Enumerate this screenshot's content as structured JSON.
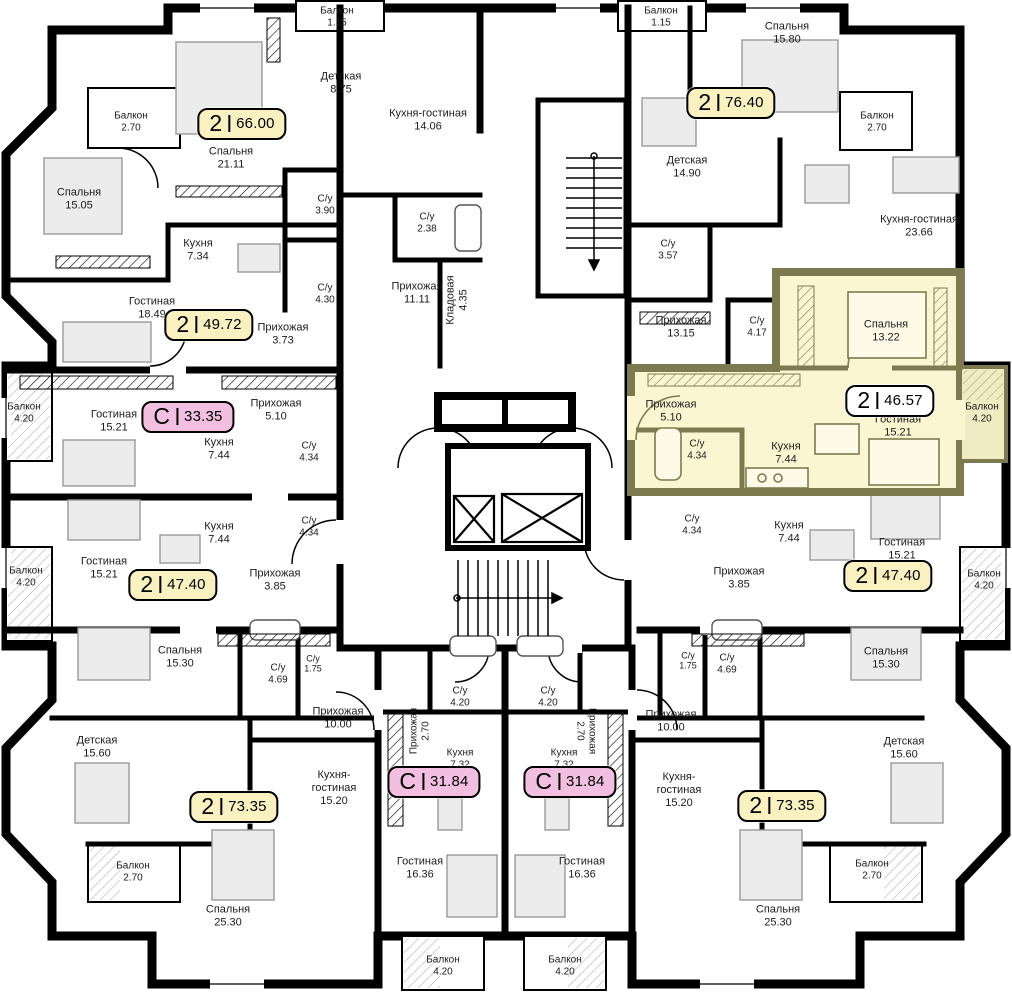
{
  "plan_name": "floor-plan",
  "colors": {
    "wall": "#000000",
    "paper": "#ffffff",
    "badge_yellow": "#f9f2c0",
    "badge_pink": "#f2bfe0",
    "badge_white": "#ffffff",
    "highlight_fill": "#faf6d2",
    "highlight_wall": "#7e7a50",
    "highlight_balcony": "#efebc2",
    "furniture_fill": "#ececec",
    "furniture_stroke": "#999999"
  },
  "icons": {
    "elevator": "elevator-shaft-icon (crossed box)",
    "stairs": "staircase-icon (treads with direction arrow)"
  },
  "apartments": [
    {
      "s": "2",
      "a": "66.00",
      "x": 242,
      "y": 124,
      "c": "yellow"
    },
    {
      "s": "2",
      "a": "76.40",
      "x": 731,
      "y": 103,
      "c": "yellow"
    },
    {
      "s": "2",
      "a": "49.72",
      "x": 209,
      "y": 325,
      "c": "yellow"
    },
    {
      "s": "С",
      "a": "33.35",
      "x": 188,
      "y": 417,
      "c": "pink"
    },
    {
      "s": "2",
      "a": "46.57",
      "x": 890,
      "y": 401,
      "c": "white"
    },
    {
      "s": "2",
      "a": "47.40",
      "x": 173,
      "y": 585,
      "c": "yellow"
    },
    {
      "s": "2",
      "a": "47.40",
      "x": 888,
      "y": 576,
      "c": "yellow"
    },
    {
      "s": "2",
      "a": "73.35",
      "x": 234,
      "y": 807,
      "c": "yellow"
    },
    {
      "s": "С",
      "a": "31.84",
      "x": 434,
      "y": 782,
      "c": "pink"
    },
    {
      "s": "С",
      "a": "31.84",
      "x": 570,
      "y": 782,
      "c": "pink"
    },
    {
      "s": "2",
      "a": "73.35",
      "x": 782,
      "y": 806,
      "c": "yellow"
    }
  ],
  "rooms": [
    {
      "n": "Балкон",
      "a": "1.15",
      "x": 337,
      "y": 17,
      "fs": 10
    },
    {
      "n": "Балкон",
      "a": "1.15",
      "x": 661,
      "y": 17,
      "fs": 10
    },
    {
      "n": "Спальня",
      "a": "15.80",
      "x": 787,
      "y": 33
    },
    {
      "n": "Детская",
      "a": "8.75",
      "x": 341,
      "y": 83
    },
    {
      "n": "Балкон",
      "a": "2.70",
      "x": 131,
      "y": 122,
      "fs": 10
    },
    {
      "n": "Балкон",
      "a": "2.70",
      "x": 877,
      "y": 122,
      "fs": 10
    },
    {
      "n": "Кухня-гостиная",
      "a": "14.06",
      "x": 428,
      "y": 120,
      "w": 80
    },
    {
      "n": "Спальня",
      "a": "21.11",
      "x": 231,
      "y": 158
    },
    {
      "n": "Детская",
      "a": "14.90",
      "x": 687,
      "y": 167
    },
    {
      "n": "Спальня",
      "a": "15.05",
      "x": 79,
      "y": 199
    },
    {
      "n": "С/у",
      "a": "3.90",
      "x": 325,
      "y": 205,
      "fs": 10
    },
    {
      "n": "С/у",
      "a": "2.38",
      "x": 427,
      "y": 223,
      "fs": 10
    },
    {
      "n": "Кухня-гостиная",
      "a": "23.66",
      "x": 919,
      "y": 226,
      "w": 130
    },
    {
      "n": "Кухня",
      "a": "7.34",
      "x": 198,
      "y": 250
    },
    {
      "n": "С/у",
      "a": "3.57",
      "x": 668,
      "y": 250,
      "fs": 10
    },
    {
      "n": "С/у",
      "a": "4.30",
      "x": 325,
      "y": 294,
      "fs": 10
    },
    {
      "n": "Прихожая",
      "a": "11.11",
      "x": 417,
      "y": 293
    },
    {
      "n": "Кладовая",
      "a": "4.35",
      "x": 457,
      "y": 300,
      "r": -90
    },
    {
      "n": "Гостиная",
      "a": "18.49",
      "x": 152,
      "y": 308
    },
    {
      "n": "Прихожая",
      "a": "13.15",
      "x": 681,
      "y": 327
    },
    {
      "n": "С/у",
      "a": "4.17",
      "x": 757,
      "y": 327,
      "fs": 10
    },
    {
      "n": "Прихожая",
      "a": "3.73",
      "x": 283,
      "y": 334
    },
    {
      "n": "Спальня",
      "a": "13.22",
      "x": 886,
      "y": 331
    },
    {
      "n": "Балкон",
      "a": "4.20",
      "x": 24,
      "y": 413,
      "fs": 10,
      "w": 44
    },
    {
      "n": "Гостиная",
      "a": "15.21",
      "x": 114,
      "y": 421
    },
    {
      "n": "Прихожая",
      "a": "5.10",
      "x": 276,
      "y": 410
    },
    {
      "n": "Прихожая",
      "a": "5.10",
      "x": 671,
      "y": 411
    },
    {
      "n": "Гостиная",
      "a": "15.21",
      "x": 898,
      "y": 426
    },
    {
      "n": "Балкон",
      "a": "4.20",
      "x": 982,
      "y": 413,
      "fs": 10,
      "w": 44
    },
    {
      "n": "Кухня",
      "a": "7.44",
      "x": 219,
      "y": 449
    },
    {
      "n": "С/у",
      "a": "4.34",
      "x": 309,
      "y": 452,
      "fs": 10
    },
    {
      "n": "С/у",
      "a": "4.34",
      "x": 697,
      "y": 450,
      "fs": 10
    },
    {
      "n": "Кухня",
      "a": "7.44",
      "x": 786,
      "y": 453
    },
    {
      "n": "С/у",
      "a": "4.34",
      "x": 309,
      "y": 527,
      "fs": 10
    },
    {
      "n": "Кухня",
      "a": "7.44",
      "x": 219,
      "y": 533
    },
    {
      "n": "С/у",
      "a": "4.34",
      "x": 692,
      "y": 525,
      "fs": 10
    },
    {
      "n": "Кухня",
      "a": "7.44",
      "x": 789,
      "y": 532
    },
    {
      "n": "Гостиная",
      "a": "15.21",
      "x": 104,
      "y": 568
    },
    {
      "n": "Гостиная",
      "a": "15.21",
      "x": 902,
      "y": 549
    },
    {
      "n": "Прихожая",
      "a": "3.85",
      "x": 275,
      "y": 580
    },
    {
      "n": "Прихожая",
      "a": "3.85",
      "x": 739,
      "y": 578
    },
    {
      "n": "Балкон",
      "a": "4.20",
      "x": 26,
      "y": 577,
      "fs": 10,
      "w": 44
    },
    {
      "n": "Балкон",
      "a": "4.20",
      "x": 984,
      "y": 580,
      "fs": 10,
      "w": 44
    },
    {
      "n": "Спальня",
      "a": "15.30",
      "x": 180,
      "y": 657
    },
    {
      "n": "Спальня",
      "a": "15.30",
      "x": 886,
      "y": 658
    },
    {
      "n": "С/у",
      "a": "4.69",
      "x": 278,
      "y": 674,
      "fs": 10
    },
    {
      "n": "С/у",
      "a": "1.75",
      "x": 313,
      "y": 664,
      "fs": 9
    },
    {
      "n": "С/у",
      "a": "1.75",
      "x": 688,
      "y": 661,
      "fs": 9
    },
    {
      "n": "С/у",
      "a": "4.69",
      "x": 727,
      "y": 664,
      "fs": 10
    },
    {
      "n": "Прихожая",
      "a": "10.00",
      "x": 338,
      "y": 718
    },
    {
      "n": "Прихожая",
      "a": "10.00",
      "x": 671,
      "y": 721
    },
    {
      "n": "Детская",
      "a": "15.60",
      "x": 97,
      "y": 747
    },
    {
      "n": "Детская",
      "a": "15.60",
      "x": 904,
      "y": 748
    },
    {
      "n": "С/у",
      "a": "4.20",
      "x": 460,
      "y": 697,
      "fs": 10
    },
    {
      "n": "С/у",
      "a": "4.20",
      "x": 548,
      "y": 697,
      "fs": 10
    },
    {
      "n": "Прихожая",
      "a": "2.70",
      "x": 420,
      "y": 731,
      "r": -90,
      "fs": 10
    },
    {
      "n": "Прихожая",
      "a": "2.70",
      "x": 586,
      "y": 731,
      "r": 90,
      "fs": 10
    },
    {
      "n": "Кухня",
      "a": "7.32",
      "x": 460,
      "y": 759,
      "fs": 10
    },
    {
      "n": "Кухня",
      "a": "7.32",
      "x": 564,
      "y": 759,
      "fs": 10
    },
    {
      "n": "Кухня-гостиная",
      "a": "15.20",
      "x": 334,
      "y": 788,
      "w": 62
    },
    {
      "n": "Кухня-гостиная",
      "a": "15.20",
      "x": 679,
      "y": 790,
      "w": 62
    },
    {
      "n": "Балкон",
      "a": "2.70",
      "x": 133,
      "y": 872,
      "fs": 10
    },
    {
      "n": "Балкон",
      "a": "2.70",
      "x": 872,
      "y": 870,
      "fs": 10
    },
    {
      "n": "Гостиная",
      "a": "16.36",
      "x": 420,
      "y": 868
    },
    {
      "n": "Гостиная",
      "a": "16.36",
      "x": 582,
      "y": 868
    },
    {
      "n": "Спальня",
      "a": "25.30",
      "x": 228,
      "y": 916
    },
    {
      "n": "Спальня",
      "a": "25.30",
      "x": 778,
      "y": 916
    },
    {
      "n": "Балкон",
      "a": "4.20",
      "x": 443,
      "y": 966,
      "fs": 10
    },
    {
      "n": "Балкон",
      "a": "4.20",
      "x": 565,
      "y": 966,
      "fs": 10
    }
  ]
}
